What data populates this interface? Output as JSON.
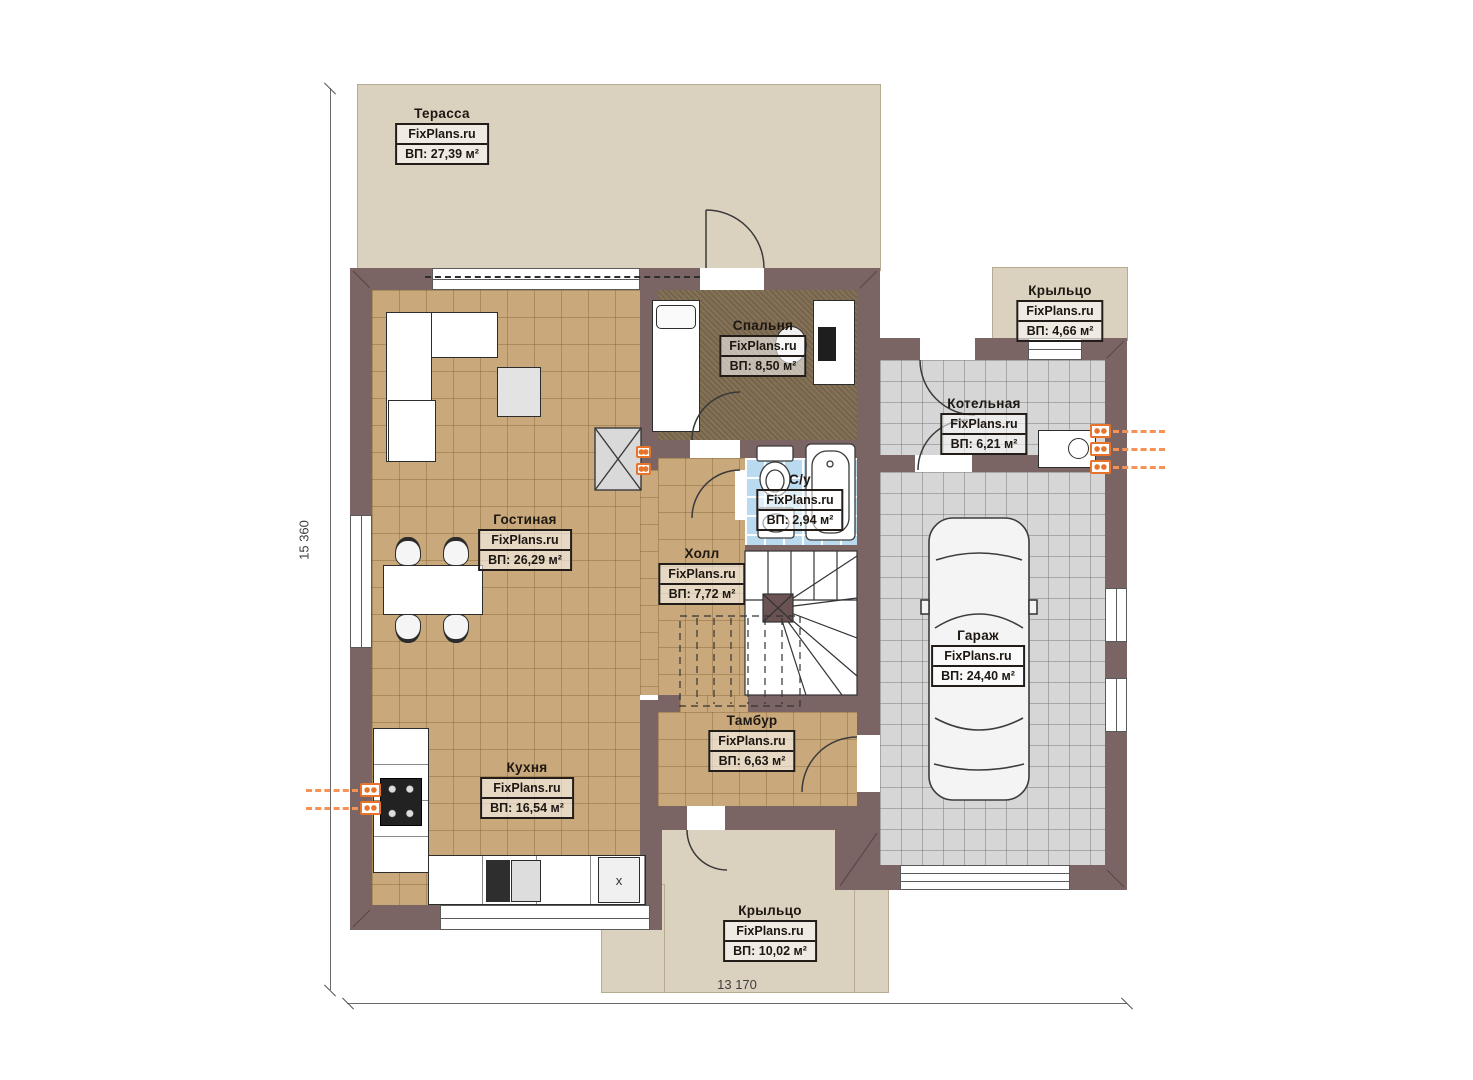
{
  "plan": {
    "brand": "FixPlans.ru",
    "dimensions": {
      "height_label": "15 360",
      "width_label": "13 170"
    },
    "rooms": [
      {
        "key": "terrace",
        "name": "Терасса",
        "brand": "FixPlans.ru",
        "area": "ВП: 27,39 м²"
      },
      {
        "key": "porch_top",
        "name": "Крыльцо",
        "brand": "FixPlans.ru",
        "area": "ВП: 4,66 м²"
      },
      {
        "key": "bedroom",
        "name": "Спальня",
        "brand": "FixPlans.ru",
        "area": "ВП: 8,50 м²"
      },
      {
        "key": "boiler",
        "name": "Котельная",
        "brand": "FixPlans.ru",
        "area": "ВП: 6,21 м²"
      },
      {
        "key": "living",
        "name": "Гостиная",
        "brand": "FixPlans.ru",
        "area": "ВП: 26,29 м²"
      },
      {
        "key": "bathroom",
        "name": "С/у",
        "brand": "FixPlans.ru",
        "area": "ВП: 2,94 м²"
      },
      {
        "key": "hall",
        "name": "Холл",
        "brand": "FixPlans.ru",
        "area": "ВП: 7,72 м²"
      },
      {
        "key": "garage",
        "name": "Гараж",
        "brand": "FixPlans.ru",
        "area": "ВП: 24,40 м²"
      },
      {
        "key": "kitchen",
        "name": "Кухня",
        "brand": "FixPlans.ru",
        "area": "ВП: 16,54 м²"
      },
      {
        "key": "vestibule",
        "name": "Тамбур",
        "brand": "FixPlans.ru",
        "area": "ВП: 6,63 м²"
      },
      {
        "key": "porch_bottom",
        "name": "Крыльцо",
        "brand": "FixPlans.ru",
        "area": "ВП: 10,02 м²"
      }
    ],
    "annotations": {
      "kitchen_marker": "x"
    }
  }
}
